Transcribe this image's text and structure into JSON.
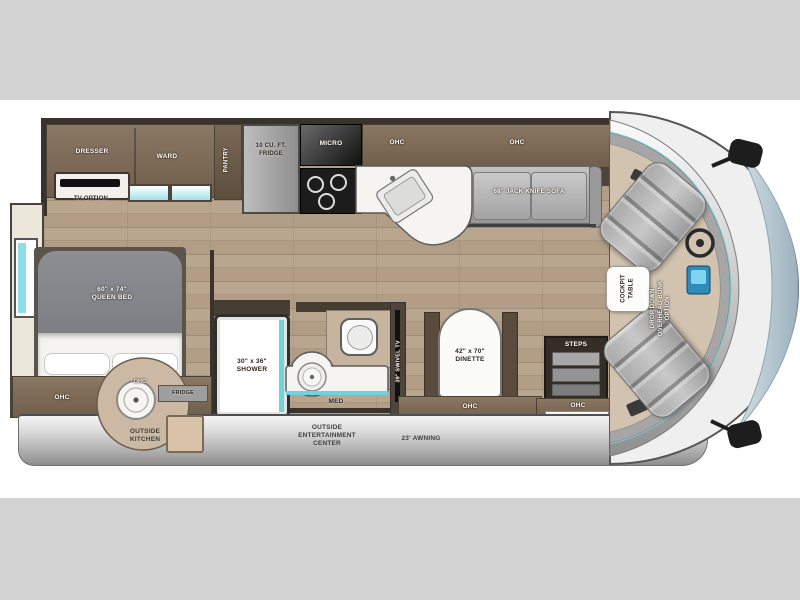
{
  "plan": {
    "ohc": "OHC",
    "dresser": "DRESSER",
    "ward": "WARD",
    "pantry": "PANTRY",
    "tv_option": "TV OPTION",
    "fridge10": "10 CU. FT.\nFRIDGE",
    "micro": "MICRO",
    "sofa": "68\" JACK KNIFE SOFA",
    "queen_bed": "60\" x 74\"\nQUEEN BED",
    "shower": "30\" x 36\"\nSHOWER",
    "med": "MED",
    "swivel_tv": "39\" SWIVEL TV",
    "dinette": "42\" x 70\"\nDINETTE",
    "steps": "STEPS",
    "fridge_small": "FRIDGE",
    "cockpit_table": "COCKPIT\nTABLE",
    "bunk_option": "DROP DOWN\nOVERHEAD BUNK\nOPTION"
  },
  "exterior": {
    "outside_kitchen": "OUTSIDE\nKITCHEN",
    "entertainment": "OUTSIDE\nENTERTAINMENT\nCENTER",
    "awning": "23' AWNING"
  },
  "colors": {
    "accent_teal": "#6fd3de",
    "cabinet_brown": "#6f5e4b",
    "floor_wood": "#b3a089",
    "front_cap_blue": "#b7c9d4",
    "band_gray": "#d3d3d3"
  }
}
